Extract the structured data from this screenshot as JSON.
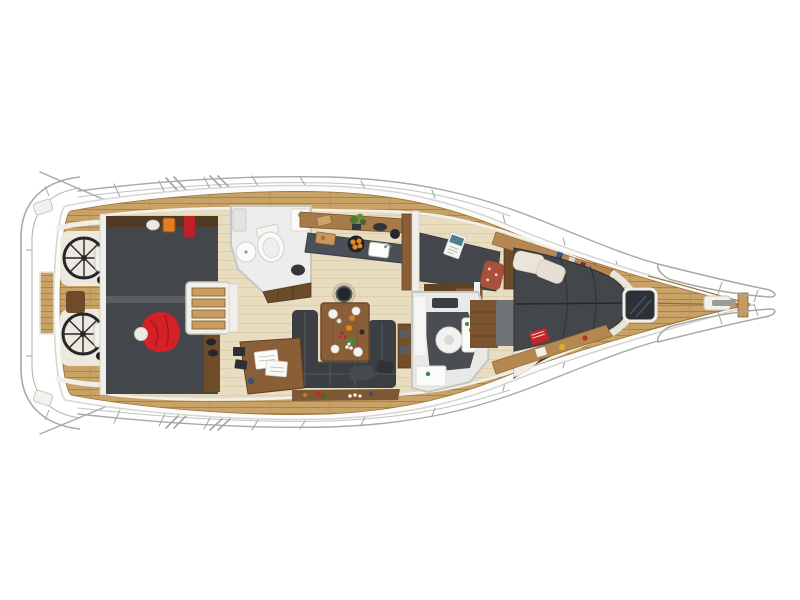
{
  "meta": {
    "description": "Top-down cutaway view of a sailing yacht interior layout, bow pointing right",
    "background": "#ffffff"
  },
  "palette": {
    "hull": "#fcfcfa",
    "hull_stroke": "#d6d5d0",
    "teak": "#c9a268",
    "teak_seam": "#a57e49",
    "floor": "#e9ddc1",
    "floor_seam": "#d9c9a6",
    "upholstery": "#3b3e42",
    "upholstery_seam": "#54585c",
    "berth": "#43464b",
    "berth_divider": "#5a5d61",
    "wood_dark": "#5e4023",
    "wood_mid": "#8a5f38",
    "wood_light": "#b68851",
    "white_fixture": "#f2f1ec",
    "fixture_stroke": "#c8c7c1",
    "bath_wall": "#edeeec",
    "counter": "#4a4f58",
    "rail": "#a8a8a4",
    "hatch": "#2c3137",
    "red": "#d32127",
    "red_dark": "#a3161d",
    "orange": "#e07f27",
    "green": "#4c7a35",
    "cream": "#eae5d8"
  },
  "regions": {
    "pushpit": "stern pushpit railing",
    "cockpit": "cockpit with twin helm wheels",
    "helm_upper": "upper helm wheel",
    "helm_lower": "lower helm wheel",
    "cockpit_table": "cockpit table",
    "swim_platform": "swim platform steps",
    "aft_cabin": "aft double berths",
    "red_jacket": "red jacket on aft berth",
    "companionway": "companionway steps",
    "aft_head": "aft bathroom with toilet and sink",
    "galley": "galley with sink and fruit bowl",
    "salon": "salon",
    "salon_table": "salon dining table",
    "salon_sofa": "U-shaped salon sofa",
    "mast": "mast base",
    "nav_station": "chart table with papers",
    "mid_cabin": "midship berth with magazine",
    "forward_head": "forward bathroom",
    "forward_cabin": "forward V-berth cabin",
    "foredeck_hatch": "foredeck hatch",
    "windlass": "anchor windlass",
    "bow_pulpit": "bow pulpit railing",
    "lifelines": "lifelines and stanchions"
  },
  "counts": {
    "helm_wheels": 2,
    "bathrooms": 2,
    "berth_areas": 4
  }
}
